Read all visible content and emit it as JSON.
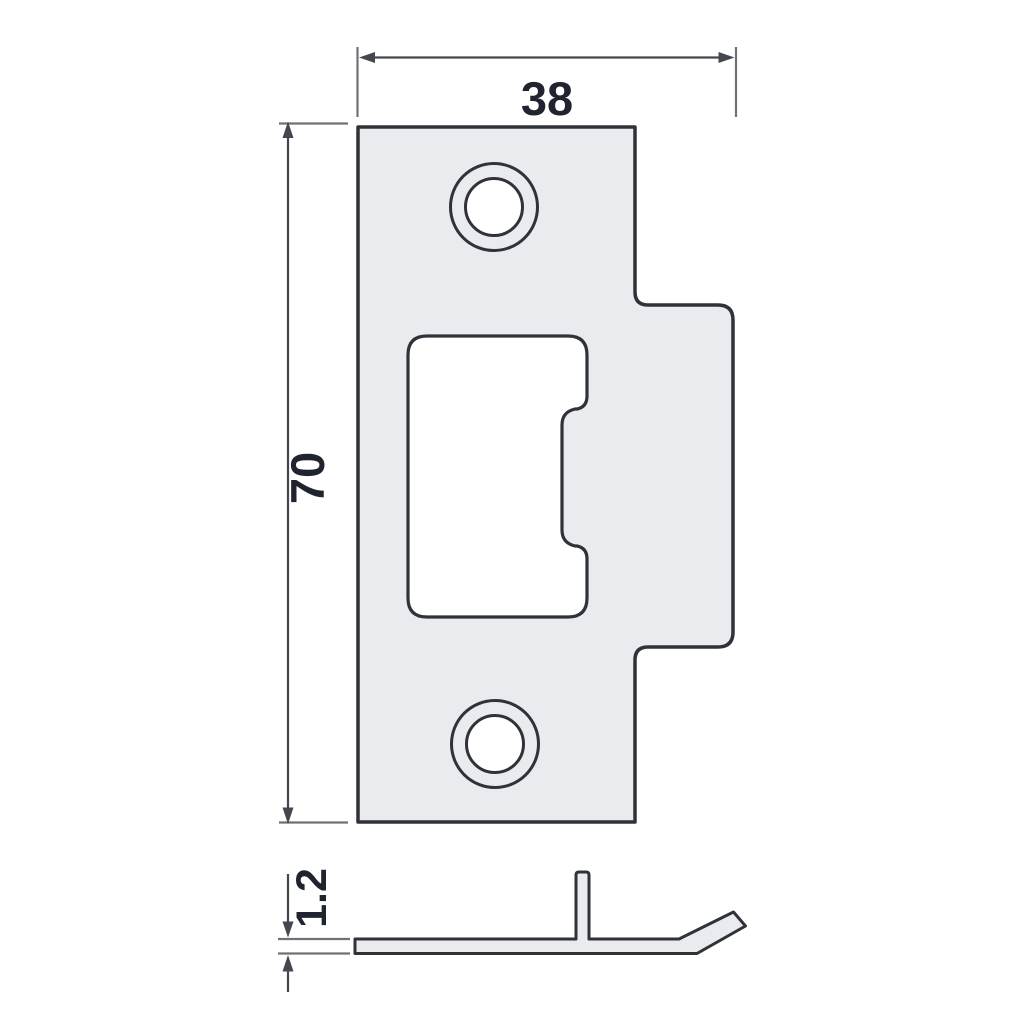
{
  "drawing": {
    "type": "technical-drawing",
    "subject": "door strike plate",
    "dimensions": {
      "width_mm": "38",
      "height_mm": "70",
      "thickness_mm": "1.2"
    },
    "views": {
      "front": "front view",
      "side": "side profile"
    },
    "colors": {
      "background": "#ffffff",
      "plate_fill": "#e9ebee",
      "outline": "#2f3339",
      "dimension_line": "#43474e",
      "extension_line": "#6e7278",
      "text": "#1f242e"
    }
  }
}
